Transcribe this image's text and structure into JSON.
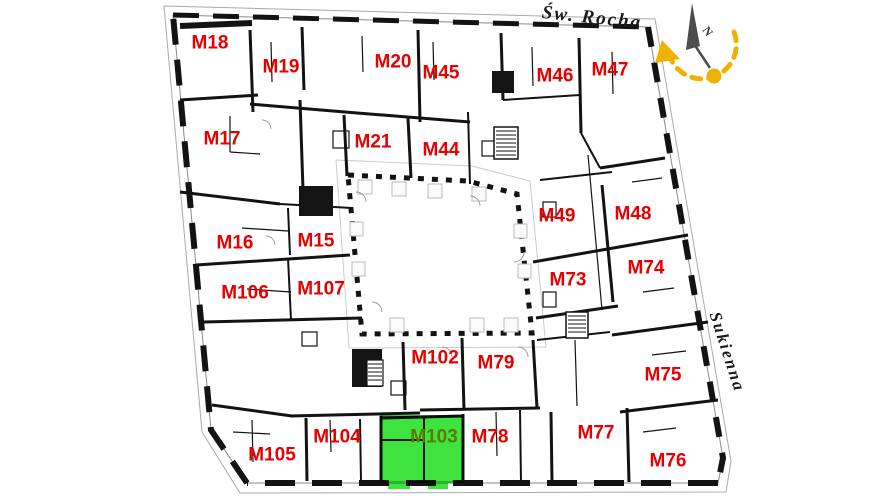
{
  "plan": {
    "streets": [
      {
        "name": "Św. Rocha"
      },
      {
        "name": "Sukienna"
      }
    ],
    "compass": {
      "north_label": "N"
    },
    "apartments": [
      {
        "id": "M18",
        "x": 210,
        "y": 43,
        "highlighted": false
      },
      {
        "id": "M19",
        "x": 281,
        "y": 67,
        "highlighted": false
      },
      {
        "id": "M20",
        "x": 393,
        "y": 62,
        "highlighted": false
      },
      {
        "id": "M45",
        "x": 441,
        "y": 73,
        "highlighted": false
      },
      {
        "id": "M46",
        "x": 555,
        "y": 76,
        "highlighted": false
      },
      {
        "id": "M47",
        "x": 610,
        "y": 70,
        "highlighted": false
      },
      {
        "id": "M17",
        "x": 222,
        "y": 139,
        "highlighted": false
      },
      {
        "id": "M21",
        "x": 373,
        "y": 142,
        "highlighted": false
      },
      {
        "id": "M44",
        "x": 441,
        "y": 150,
        "highlighted": false
      },
      {
        "id": "M49",
        "x": 557,
        "y": 216,
        "highlighted": false
      },
      {
        "id": "M48",
        "x": 633,
        "y": 214,
        "highlighted": false
      },
      {
        "id": "M16",
        "x": 235,
        "y": 243,
        "highlighted": false
      },
      {
        "id": "M15",
        "x": 316,
        "y": 241,
        "highlighted": false
      },
      {
        "id": "M73",
        "x": 568,
        "y": 280,
        "highlighted": false
      },
      {
        "id": "M74",
        "x": 646,
        "y": 268,
        "highlighted": false
      },
      {
        "id": "M106",
        "x": 245,
        "y": 293,
        "highlighted": false
      },
      {
        "id": "M107",
        "x": 321,
        "y": 289,
        "highlighted": false
      },
      {
        "id": "M102",
        "x": 435,
        "y": 358,
        "highlighted": false
      },
      {
        "id": "M79",
        "x": 496,
        "y": 363,
        "highlighted": false
      },
      {
        "id": "M75",
        "x": 663,
        "y": 375,
        "highlighted": false
      },
      {
        "id": "M104",
        "x": 337,
        "y": 437,
        "highlighted": false
      },
      {
        "id": "M103",
        "x": 434,
        "y": 437,
        "highlighted": true
      },
      {
        "id": "M78",
        "x": 490,
        "y": 437,
        "highlighted": false
      },
      {
        "id": "M77",
        "x": 596,
        "y": 433,
        "highlighted": false
      },
      {
        "id": "M105",
        "x": 272,
        "y": 455,
        "highlighted": false
      },
      {
        "id": "M76",
        "x": 668,
        "y": 461,
        "highlighted": false
      }
    ],
    "colors": {
      "apartment_label": "#e60000",
      "highlight_fill": "#3fe33f",
      "highlight_border": "#12b512",
      "highlight_label": "#5e7a00",
      "compass_accent": "#f0b202",
      "walls": "#131313"
    }
  }
}
